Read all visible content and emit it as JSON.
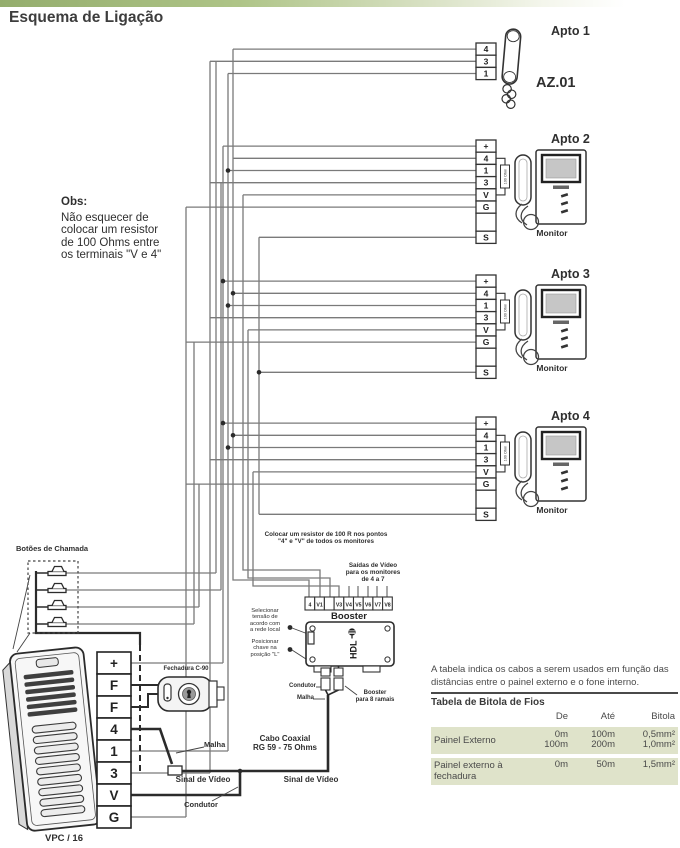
{
  "title": "Esquema de Ligação",
  "obs": {
    "heading": "Obs:",
    "lines": [
      "Não esquecer de",
      "colocar um resistor",
      "de 100 Ohms entre",
      "os terminais \"V e 4\""
    ]
  },
  "apto1": {
    "label": "Apto 1",
    "model": "AZ.01",
    "terminals": [
      "4",
      "3",
      "1"
    ]
  },
  "monitors": [
    {
      "label": "Apto 2",
      "caption": "Monitor",
      "terminals": [
        "+",
        "4",
        "1",
        "3",
        "V",
        "G",
        "S"
      ],
      "resistor": "100 Ohm"
    },
    {
      "label": "Apto 3",
      "caption": "Monitor",
      "terminals": [
        "+",
        "4",
        "1",
        "3",
        "V",
        "G",
        "S"
      ],
      "resistor": "100 Ohm"
    },
    {
      "label": "Apto 4",
      "caption": "Monitor",
      "terminals": [
        "+",
        "4",
        "1",
        "3",
        "V",
        "G",
        "S"
      ],
      "resistor": "100 Ohm"
    }
  ],
  "buttons_box": {
    "label": "Botões de Chamada"
  },
  "panel": {
    "label": "VPC / 16",
    "terminals": [
      "+",
      "F",
      "F",
      "4",
      "1",
      "3",
      "V",
      "G"
    ]
  },
  "lock": {
    "label": "Fechadura C-90"
  },
  "booster": {
    "label": "Booster",
    "brand": "HDL",
    "terminals": [
      "4",
      "V1",
      "V2",
      "V3",
      "V4",
      "V5",
      "V6",
      "V7",
      "V8"
    ]
  },
  "notes": {
    "resistor_note": [
      "Colocar um resistor de 100 R nos pontos",
      "\"4\" e \"V\" de todos os monitores"
    ],
    "video_out_note": [
      "Saídas de Vídeo",
      "para os monitores",
      "de 4 a 7"
    ],
    "select_voltage": [
      "Selecionar",
      "tensão de",
      "acordo com",
      "a rede local"
    ],
    "switch_position": [
      "Posicionar",
      "chave na",
      "posição \"L\""
    ],
    "booster_conductor": "Condutor",
    "booster_shield": "Malha",
    "booster_branches": [
      "Booster",
      "para 8 ramais"
    ],
    "coax": [
      "Cabo Coaxial",
      "RG 59  -  75 Ohms"
    ],
    "shield": "Malha",
    "video_signal_left": "Sinal de Vídeo",
    "video_signal_right": "Sinal de Vídeo",
    "conductor": "Condutor"
  },
  "table": {
    "intro": "A tabela indica os cabos a serem usados em função das distâncias entre o painel externo e o fone interno.",
    "title": "Tabela de Bitola de Fios",
    "columns": [
      "De",
      "Até",
      "Bitola"
    ],
    "rows": [
      {
        "label": "Painel Externo",
        "de": [
          "0m",
          "100m"
        ],
        "ate": [
          "100m",
          "200m"
        ],
        "bitola": [
          "0,5mm²",
          "1,0mm²"
        ]
      },
      {
        "label": "Painel externo à fechadura",
        "de": [
          "0m"
        ],
        "ate": [
          "50m"
        ],
        "bitola": [
          "1,5mm²"
        ]
      }
    ]
  },
  "colors": {
    "accent_green": "#94ad6d",
    "row_green": "#dfe3ca",
    "wire_gray": "#7a7a7a",
    "wire_dark": "#2b2b2b"
  }
}
